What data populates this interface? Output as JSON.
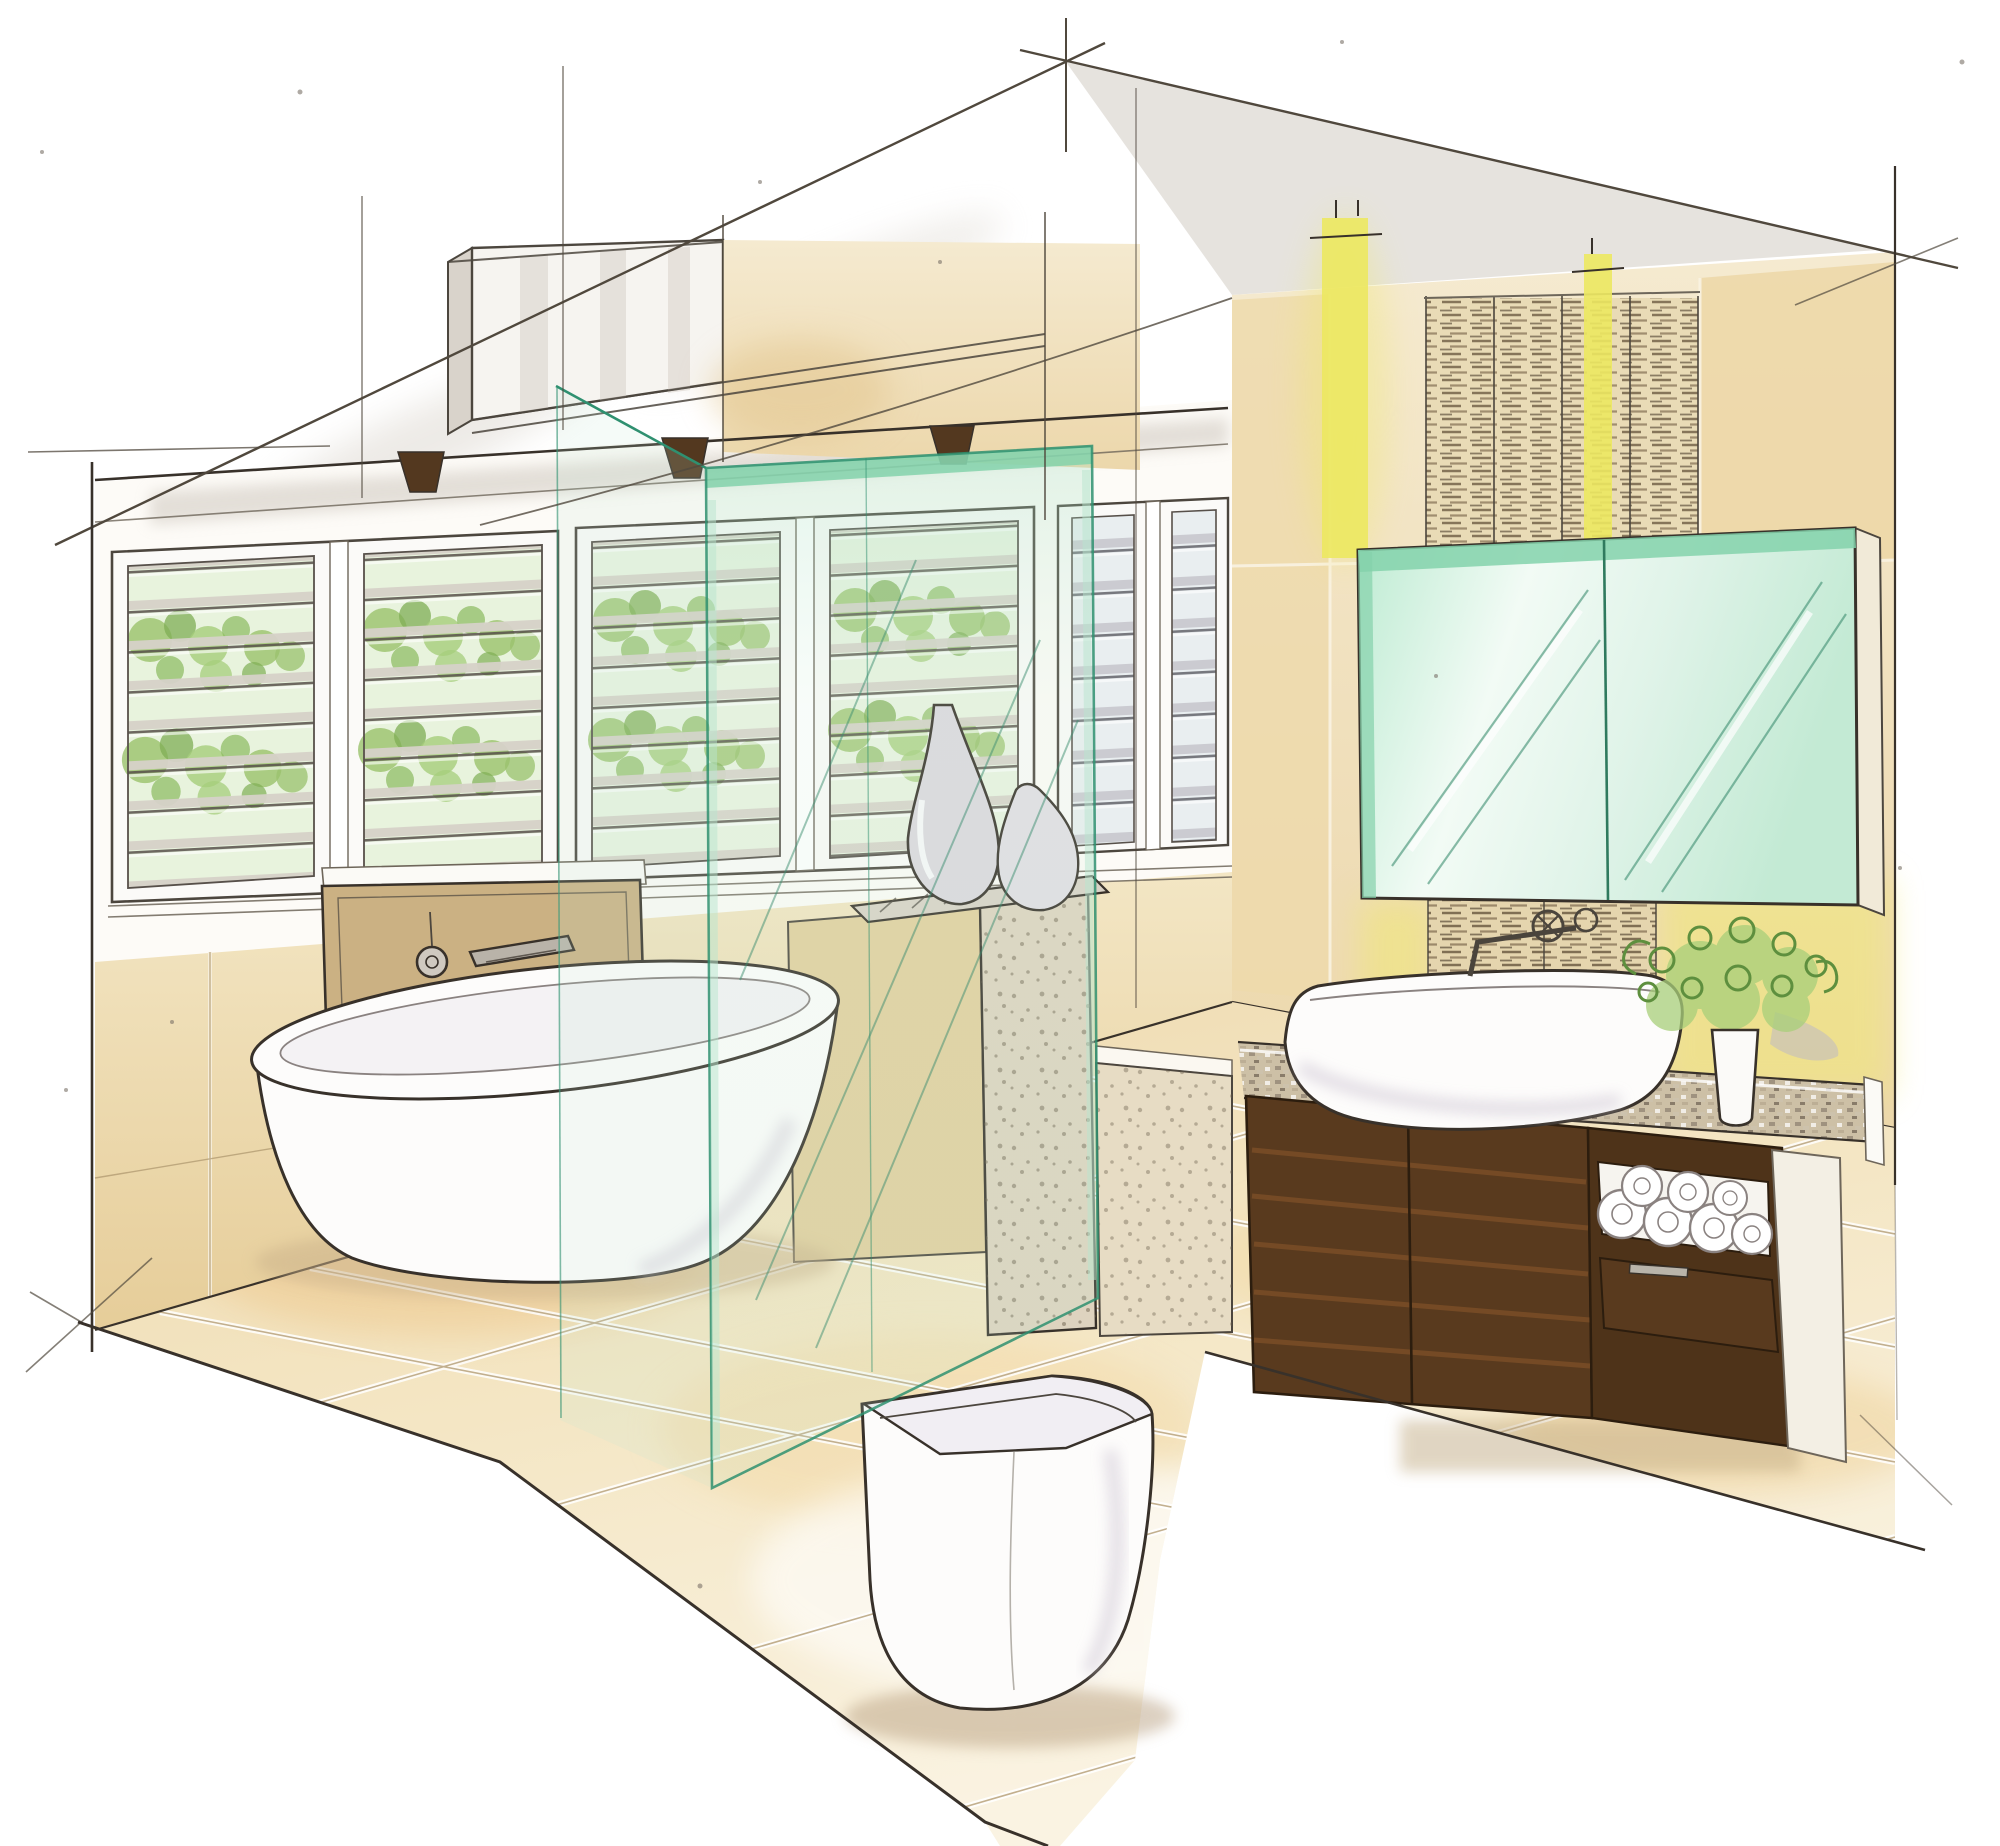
{
  "meta": {
    "kind": "hand-drawn interior design concept sketch",
    "room": "bathroom",
    "view": "two-point perspective marker rendering",
    "visible_text": ""
  },
  "palette": {
    "paper": "#ffffff",
    "ink": "#38312a",
    "pencil": "#6e665a",
    "wall_white": "#fdfbf7",
    "wall_tan": "#f0e0bb",
    "wall_tan_deep": "#e6cd99",
    "floor_tan": "#f2e2bd",
    "floor_warm": "#edc383",
    "glass_mint": "#bfe8d2",
    "glass_edge": "#2f9070",
    "glass_band": "#84d2ab",
    "mirror_mint": "#e2f5ea",
    "yellow_light": "#ece860",
    "wood_dark": "#593a1e",
    "wood_mid": "#7c4f27",
    "fixture_white": "#fdfcfb",
    "fixture_shade": "#d8d1dc",
    "foliage_green": "#95c468",
    "slat_gray": "#d6d1c8",
    "slat_dark": "#57504a",
    "stone_speckle": "#ded3bf",
    "woven_brown": "#6f5d44",
    "silver": "#b9b4aa",
    "ceiling_gray": "#d7d1c9"
  },
  "objects": [
    {
      "name": "louver-window-wall",
      "note": "three white plantation-louver window sets with greenery beyond"
    },
    {
      "name": "clerestory-bulkhead",
      "note": "raised ceiling box with bracketed shelf below"
    },
    {
      "name": "freestanding-bathtub",
      "note": "white oval tub"
    },
    {
      "name": "bath-filler-panel",
      "note": "stone mixer panel with round control and spout"
    },
    {
      "name": "glass-shower-screen",
      "note": "frameless green-tinted glass panels"
    },
    {
      "name": "decor-vases",
      "note": "two teardrop vases on half-height ledge"
    },
    {
      "name": "stone-pier",
      "note": "speckled stone half wall"
    },
    {
      "name": "wall-faced-toilet",
      "note": "modern back-to-wall pan"
    },
    {
      "name": "floating-vanity",
      "note": "walnut wall-hung vanity with towel niche and drawer"
    },
    {
      "name": "vessel-basin",
      "note": "white counter-top basin with wall mixer"
    },
    {
      "name": "mirror-cabinet",
      "note": "green-glass two door mirrored cabinet"
    },
    {
      "name": "woven-feature-panels",
      "note": "dark timber woven slat wall panels"
    },
    {
      "name": "pendant-light-battens",
      "note": "two yellow suspended light strips"
    },
    {
      "name": "plant-in-vase",
      "note": "curly green foliage in white taper vase"
    },
    {
      "name": "tiled-floor",
      "note": "large-format warm stone tiles"
    },
    {
      "name": "construction-lines",
      "note": "perspective setup pencil lines"
    }
  ]
}
